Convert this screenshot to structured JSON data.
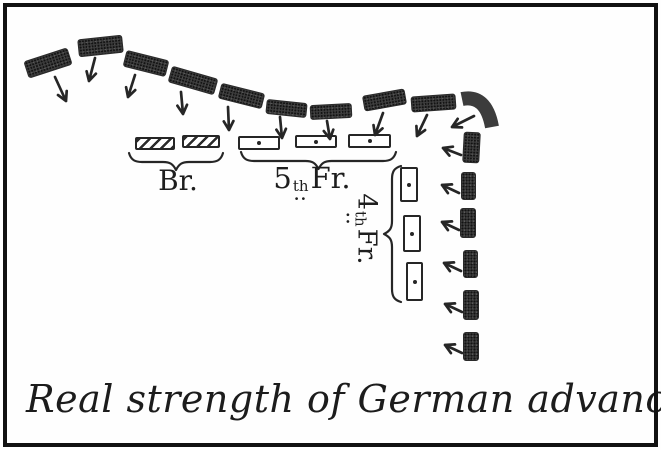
{
  "meta": {
    "caption": "Real strength of German advance"
  },
  "colors": {
    "paper": "#fefefe",
    "ink": "#262626",
    "unit_fill": "#3c3c3c",
    "frame": "#111111"
  },
  "labels": {
    "british": "Br.",
    "french_5th": {
      "num": "5",
      "ord": "th",
      "dots": "..",
      "name": "Fr."
    },
    "french_4th": {
      "num": "4",
      "ord": "th",
      "dots": "..",
      "name": "Fr."
    }
  },
  "diagram": {
    "german_front_units": [
      {
        "cx": 48,
        "cy": 63,
        "w": 46,
        "h": 18,
        "rot": -18
      },
      {
        "cx": 100,
        "cy": 46,
        "w": 45,
        "h": 18,
        "rot": -6
      },
      {
        "cx": 146,
        "cy": 63,
        "w": 44,
        "h": 17,
        "rot": 14
      },
      {
        "cx": 193,
        "cy": 80,
        "w": 48,
        "h": 17,
        "rot": 16
      },
      {
        "cx": 241,
        "cy": 96,
        "w": 45,
        "h": 16,
        "rot": 14
      },
      {
        "cx": 286,
        "cy": 108,
        "w": 41,
        "h": 15,
        "rot": 6
      },
      {
        "cx": 331,
        "cy": 111,
        "w": 42,
        "h": 15,
        "rot": -3
      },
      {
        "cx": 384,
        "cy": 100,
        "w": 43,
        "h": 16,
        "rot": -10
      },
      {
        "cx": 433,
        "cy": 103,
        "w": 45,
        "h": 16,
        "rot": -4
      }
    ],
    "german_corner_unit": {
      "path": "M462 99 Q486 94 492 127",
      "thickness": 14
    },
    "german_flank_units": [
      {
        "cx": 471,
        "cy": 147,
        "w": 17,
        "h": 31,
        "rot": 3
      },
      {
        "cx": 468,
        "cy": 186,
        "w": 15,
        "h": 28,
        "rot": 0
      },
      {
        "cx": 468,
        "cy": 223,
        "w": 16,
        "h": 30,
        "rot": 0
      },
      {
        "cx": 470,
        "cy": 264,
        "w": 15,
        "h": 28,
        "rot": 0
      },
      {
        "cx": 471,
        "cy": 305,
        "w": 16,
        "h": 30,
        "rot": 0
      },
      {
        "cx": 471,
        "cy": 346,
        "w": 16,
        "h": 29,
        "rot": 0
      }
    ],
    "advance_arrows_front": [
      [
        55,
        77,
        66,
        101
      ],
      [
        95,
        58,
        89,
        81
      ],
      [
        135,
        75,
        128,
        97
      ],
      [
        181,
        92,
        183,
        114
      ],
      [
        228,
        107,
        229,
        130
      ],
      [
        280,
        117,
        282,
        138
      ],
      [
        327,
        121,
        330,
        139
      ],
      [
        383,
        113,
        375,
        135
      ],
      [
        427,
        115,
        417,
        136
      ],
      [
        474,
        116,
        452,
        127
      ]
    ],
    "advance_arrows_flank": [
      [
        461,
        155,
        443,
        148
      ],
      [
        459,
        193,
        442,
        185
      ],
      [
        459,
        230,
        442,
        222
      ],
      [
        461,
        271,
        444,
        263
      ],
      [
        462,
        312,
        445,
        304
      ],
      [
        462,
        353,
        445,
        345
      ]
    ],
    "british_units": [
      {
        "x": 135,
        "y": 137,
        "w": 40,
        "h": 13
      },
      {
        "x": 182,
        "y": 135,
        "w": 38,
        "h": 13
      }
    ],
    "french_5th_units": [
      {
        "x": 238,
        "y": 136,
        "w": 42,
        "h": 14
      },
      {
        "x": 295,
        "y": 135,
        "w": 42,
        "h": 13
      },
      {
        "x": 348,
        "y": 134,
        "w": 43,
        "h": 14
      }
    ],
    "french_4th_units": [
      {
        "x": 400,
        "y": 167,
        "w": 18,
        "h": 35
      },
      {
        "x": 403,
        "y": 215,
        "w": 18,
        "h": 37
      },
      {
        "x": 406,
        "y": 262,
        "w": 17,
        "h": 39
      }
    ],
    "braces": {
      "british": {
        "x": 128,
        "y": 151,
        "width": 96,
        "orient": "h"
      },
      "french_5th": {
        "x": 240,
        "y": 150,
        "width": 157,
        "orient": "h"
      },
      "french_4th": {
        "cx": 393,
        "cy": 234,
        "width": 138,
        "orient": "v"
      }
    }
  }
}
